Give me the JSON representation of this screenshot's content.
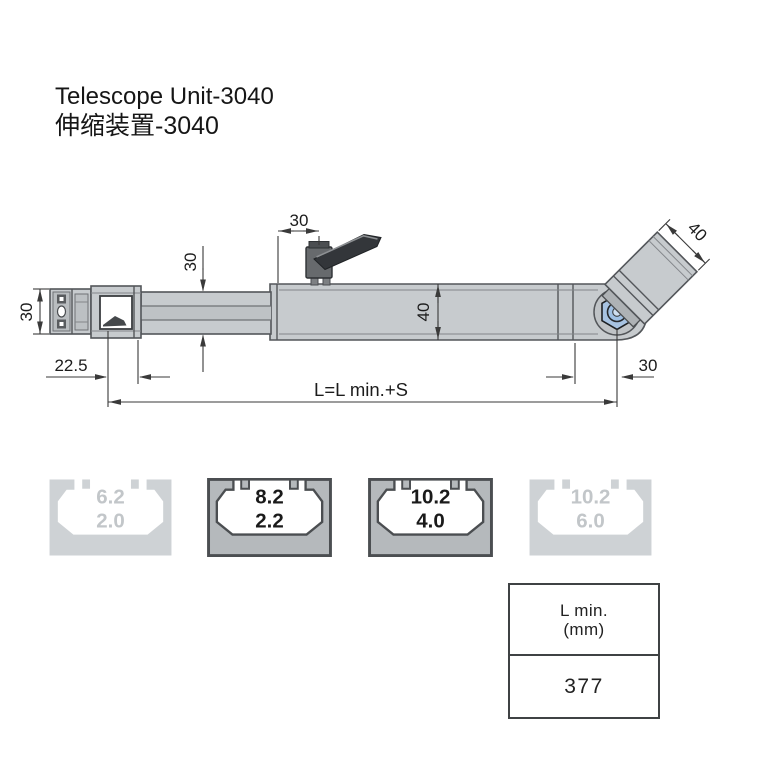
{
  "title": {
    "line1": "Telescope Unit-3040",
    "line2": "伸缩装置-3040"
  },
  "drawing": {
    "dimensions": {
      "end_section_height": "30",
      "inner_beam_height": "30",
      "lever_offset": "30",
      "outer_beam_height": "40",
      "arm_section_width": "40",
      "pivot_to_end": "30",
      "end_offset": "22.5",
      "total_length": "L=L min.+S"
    },
    "colors": {
      "body_fill": "#c7cbce",
      "outline": "#53565a",
      "dimension_lines": "#3a3a3a",
      "pivot_blue": "#a7c3e2",
      "lever_dark": "#33363a"
    }
  },
  "profiles": {
    "items": [
      {
        "slot_width": "6.2",
        "wall": "2.0",
        "highlighted": false
      },
      {
        "slot_width": "8.2",
        "wall": "2.2",
        "highlighted": true
      },
      {
        "slot_width": "10.2",
        "wall": "4.0",
        "highlighted": true
      },
      {
        "slot_width": "10.2",
        "wall": "6.0",
        "highlighted": false
      }
    ]
  },
  "spec_table": {
    "header": {
      "line1": "L min.",
      "line2": "(mm)"
    },
    "value": "377"
  }
}
